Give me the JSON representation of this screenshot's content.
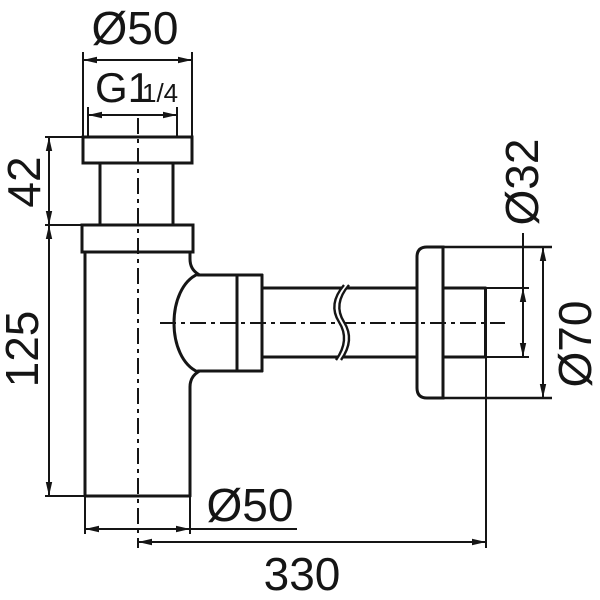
{
  "drawing": {
    "labels": {
      "top_diameter": "Ø50",
      "thread_main": "G1",
      "thread_suffix": "1/4",
      "inlet_height": "42",
      "body_height": "125",
      "pipe_diameter": "Ø32",
      "flange_diameter": "Ø70",
      "body_diameter": "Ø50",
      "length": "330"
    },
    "colors": {
      "line": "#151515",
      "background": "#ffffff"
    }
  }
}
